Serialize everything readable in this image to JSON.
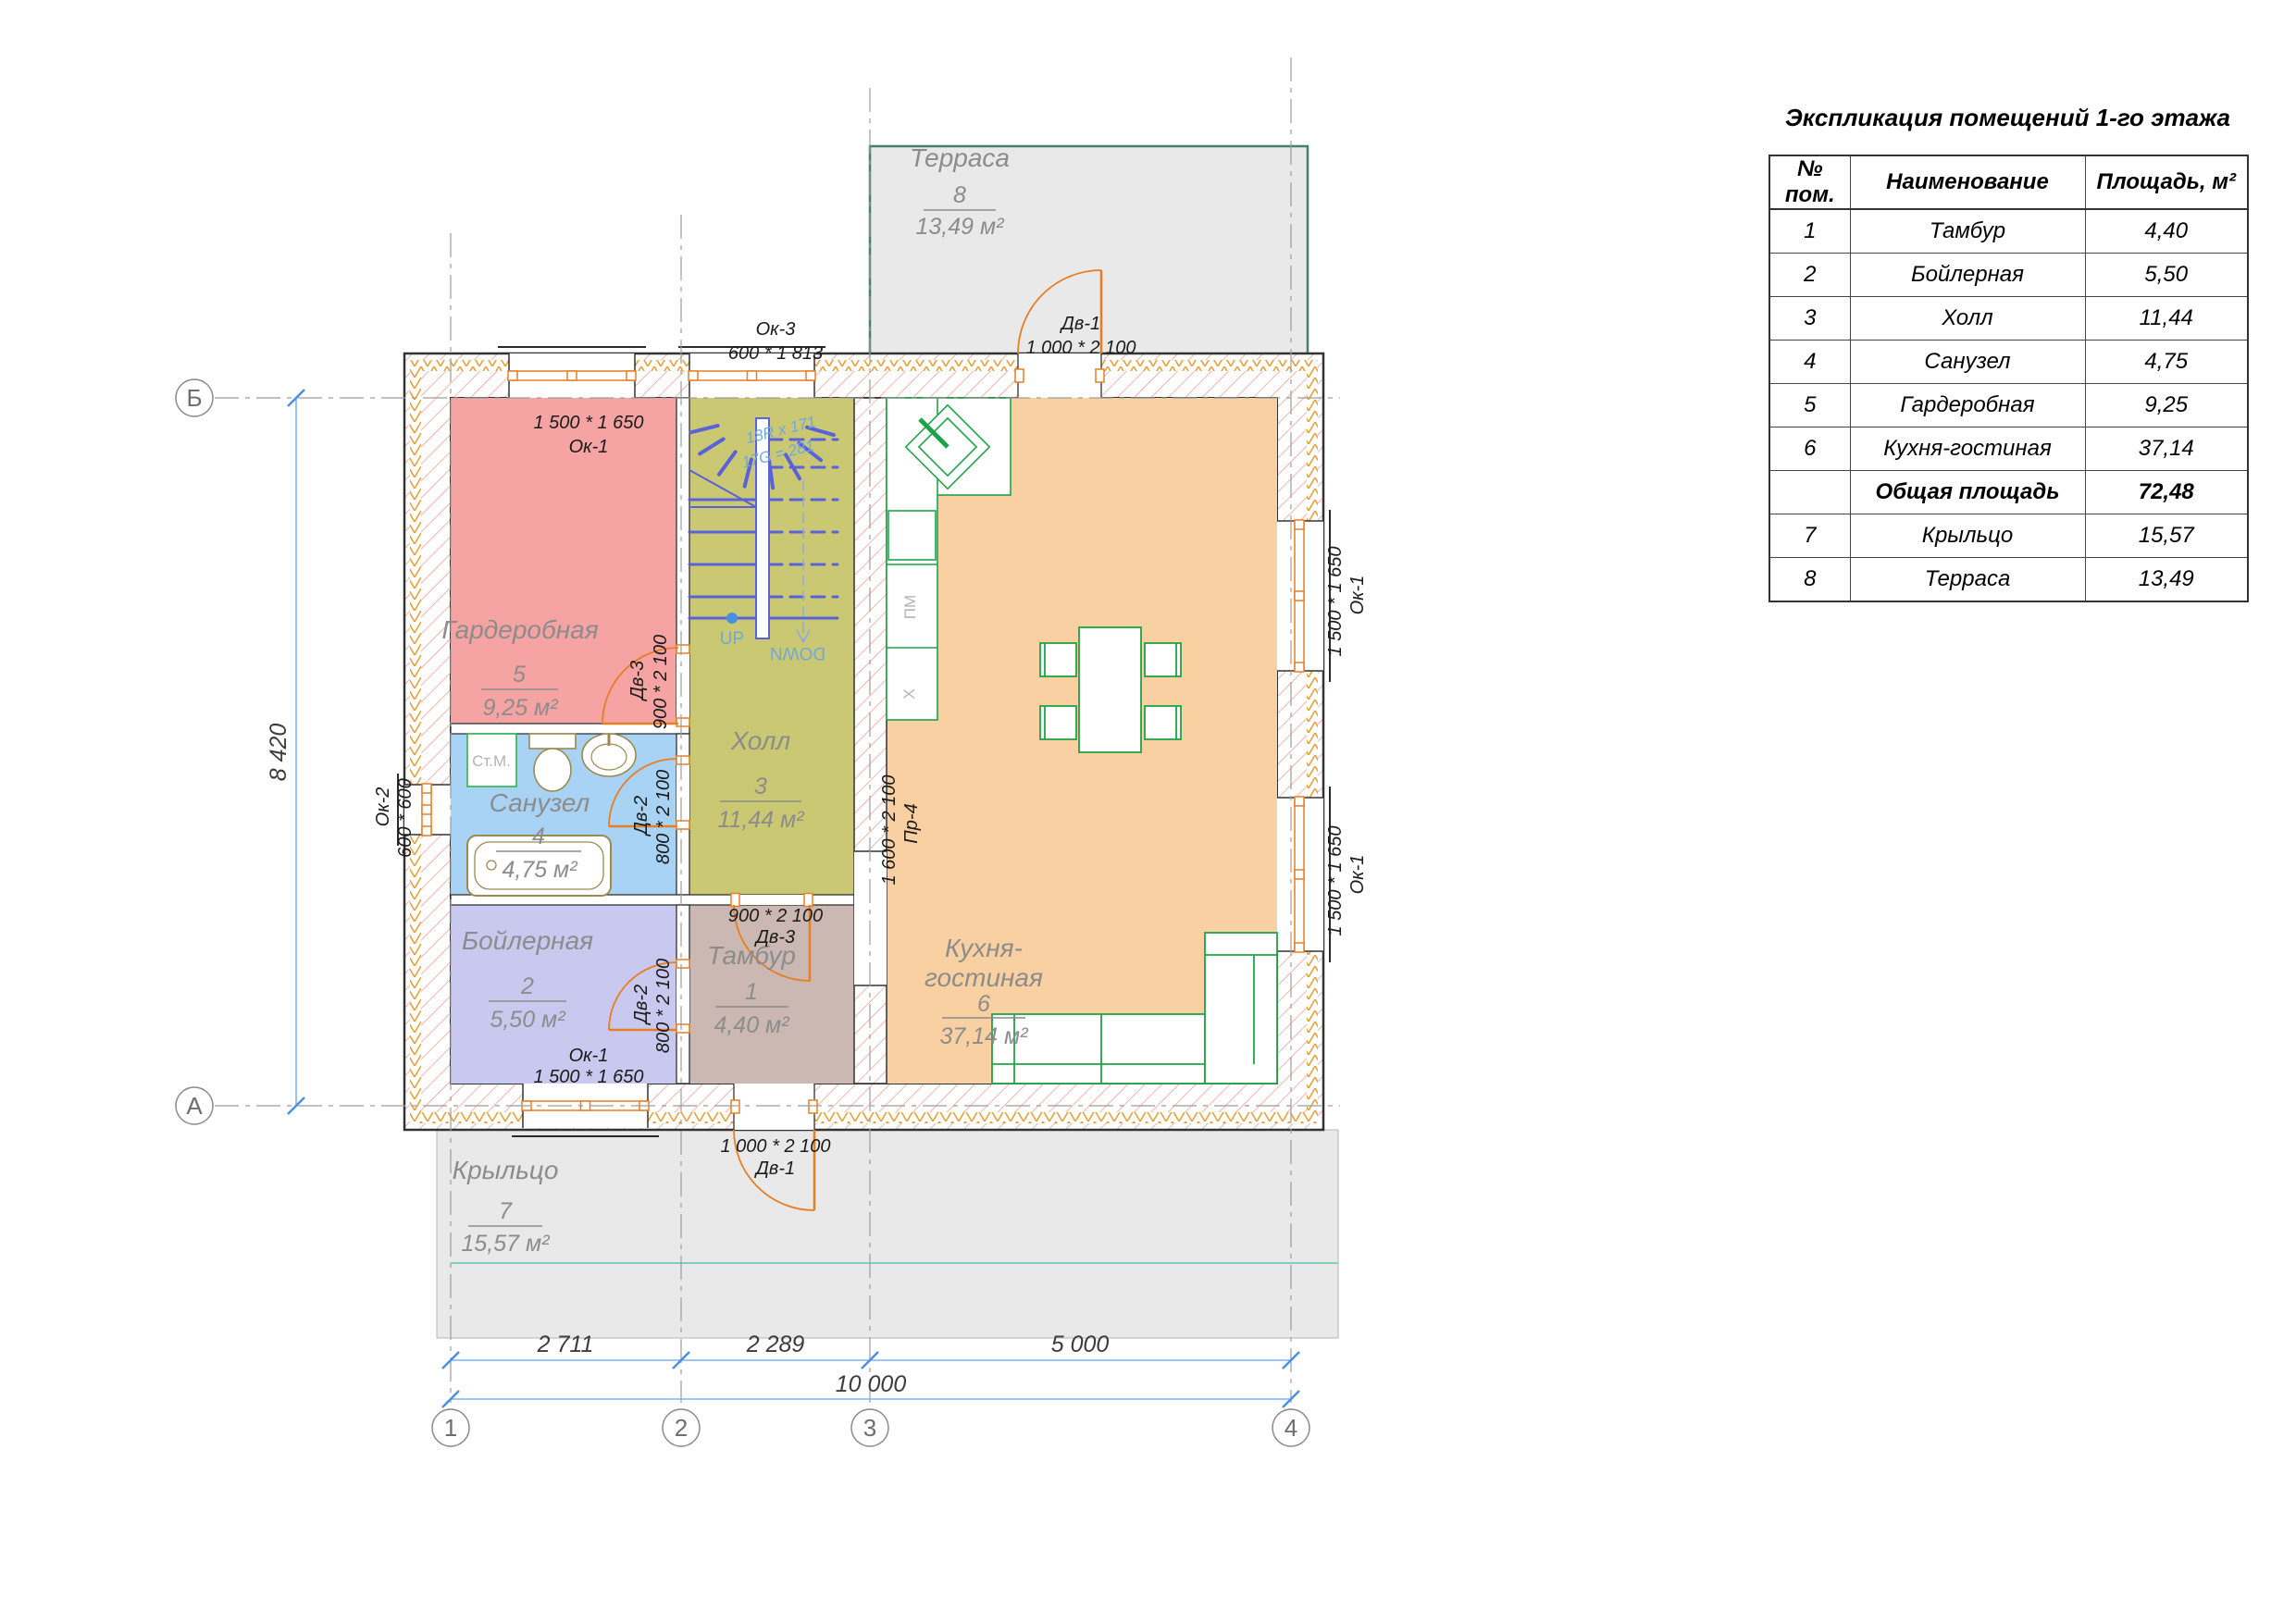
{
  "legend": {
    "title": "Экспликация помещений 1-го этажа",
    "columns": [
      "№ пом.",
      "Наименование",
      "Площадь, м²"
    ],
    "rows": [
      {
        "num": "1",
        "name": "Тамбур",
        "area": "4,40",
        "bold": false
      },
      {
        "num": "2",
        "name": "Бойлерная",
        "area": "5,50",
        "bold": false
      },
      {
        "num": "3",
        "name": "Холл",
        "area": "11,44",
        "bold": false
      },
      {
        "num": "4",
        "name": "Санузел",
        "area": "4,75",
        "bold": false
      },
      {
        "num": "5",
        "name": "Гардеробная",
        "area": "9,25",
        "bold": false
      },
      {
        "num": "6",
        "name": "Кухня-гостиная",
        "area": "37,14",
        "bold": false
      },
      {
        "num": "",
        "name": "Общая площадь",
        "area": "72,48",
        "bold": true
      },
      {
        "num": "7",
        "name": "Крыльцо",
        "area": "15,57",
        "bold": false
      },
      {
        "num": "8",
        "name": "Терраса",
        "area": "13,49",
        "bold": false
      }
    ]
  },
  "rooms": {
    "garderobnaya": {
      "name": "Гардеробная",
      "num": "5",
      "area": "9,25 м²"
    },
    "sanuzel": {
      "name": "Санузел",
      "num": "4",
      "area": "4,75 м²"
    },
    "holl": {
      "name": "Холл",
      "num": "3",
      "area": "11,44 м²"
    },
    "boilernaya": {
      "name": "Бойлерная",
      "num": "2",
      "area": "5,50 м²"
    },
    "tambur": {
      "name": "Тамбур",
      "num": "1",
      "area": "4,40 м²"
    },
    "kitchen": {
      "name_line1": "Кухня-",
      "name_line2": "гостиная",
      "num": "6",
      "area": "37,14 м²"
    },
    "terrasa": {
      "name": "Терраса",
      "num": "8",
      "area": "13,49 м²"
    },
    "kryltso": {
      "name": "Крыльцо",
      "num": "7",
      "area": "15,57 м²"
    }
  },
  "tags": {
    "ok3_top": {
      "name": "Ок-3",
      "size": "600 * 1 813"
    },
    "dv1_top": {
      "name": "Дв-1",
      "size": "1 000 * 2 100"
    },
    "ok1_garderob": {
      "name": "Ок-1",
      "size": "1 500 * 1 650"
    },
    "dv3_garderob": {
      "name": "Дв-3",
      "size": "900 * 2 100"
    },
    "ok2_left": {
      "name": "Ок-2",
      "size": "600 * 600"
    },
    "dv2_sanuzel": {
      "name": "Дв-2",
      "size": "800 * 2 100"
    },
    "dv2_boiler": {
      "name": "Дв-2",
      "size": "800 * 2 100"
    },
    "dv3_tambur": {
      "name": "Дв-3",
      "size": "900 * 2 100"
    },
    "ok1_boiler": {
      "name": "Ок-1",
      "size": "1 500 * 1 650"
    },
    "dv1_bottom": {
      "name": "Дв-1",
      "size": "1 000 * 2 100"
    },
    "ok1_right_top": {
      "name": "Ок-1",
      "size": "1 500 * 1 650"
    },
    "ok1_right_bot": {
      "name": "Ок-1",
      "size": "1 500 * 1 650"
    },
    "pr4": {
      "name": "Пр-4",
      "size": "1 600 * 2 100"
    }
  },
  "stairs": {
    "note1": "18R x 171",
    "note2": "17G = 281",
    "up": "UP",
    "down": "DOWN"
  },
  "appliances": {
    "washing_machine": "Ст.М.",
    "dishwasher": "ПМ",
    "fridge": "X"
  },
  "dimensions": {
    "d1": "2 711",
    "d2": "2 289",
    "d3": "5 000",
    "total": "10 000",
    "height": "8 420"
  },
  "grid": {
    "c1": "1",
    "c2": "2",
    "c3": "3",
    "c4": "4",
    "rowA": "А",
    "rowB": "Б"
  },
  "colors": {
    "garderobnaya": "#f5a3a3",
    "sanuzel": "#a9d3f5",
    "holl": "#cbc873",
    "boilernaya": "#c9c9ef",
    "tambur": "#ccb8b2",
    "kitchen": "#f9d0a2",
    "outdoor": "#e9e9e9",
    "hatch": "#ef9488",
    "insulation": "#e8a23c",
    "frame_orange": "#e87e22",
    "furniture_green": "#1fa348",
    "fixture_tan": "#9a8a50",
    "stairs_blue": "#5a62d8",
    "dim_blue": "#7fb3f5",
    "terrace_border": "#44806e"
  }
}
